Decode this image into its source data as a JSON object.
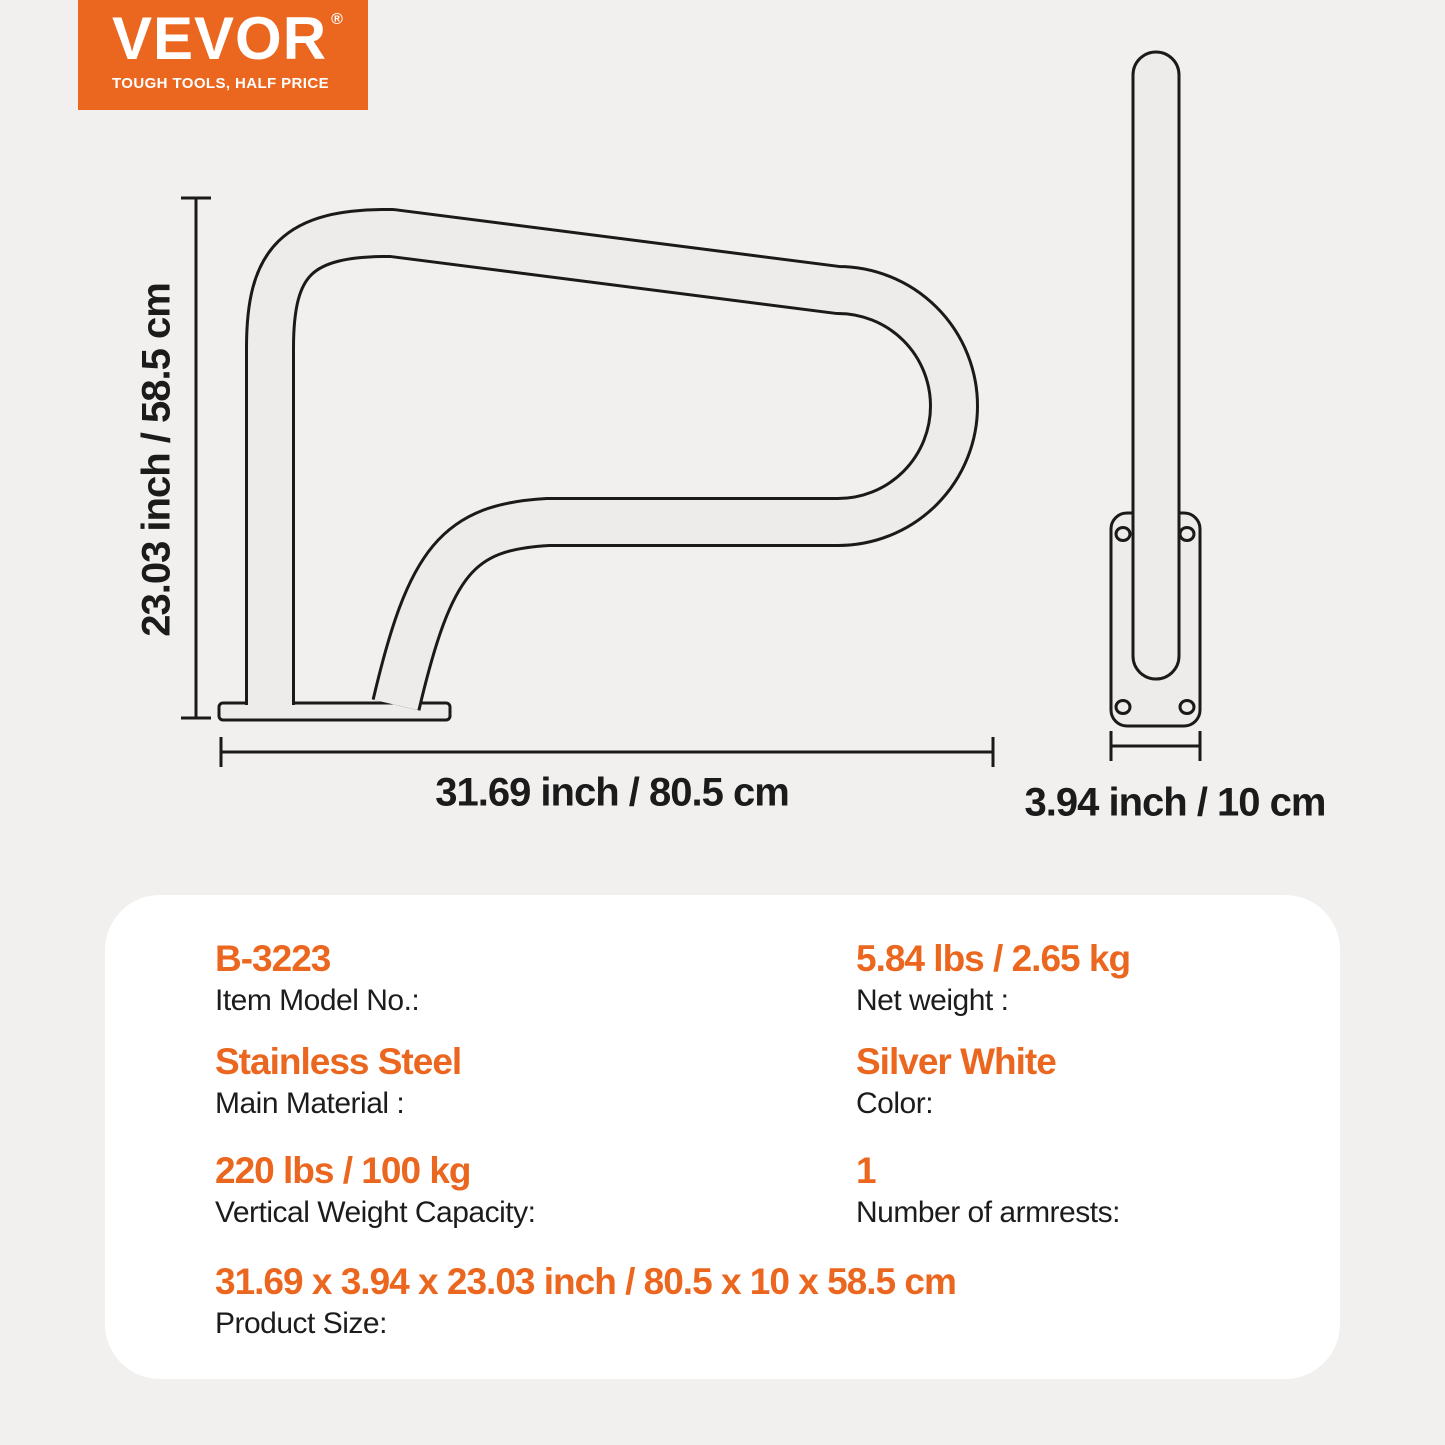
{
  "brand": {
    "name": "VEVOR",
    "registered_mark": "®",
    "tagline": "TOUGH TOOLS, HALF PRICE"
  },
  "colors": {
    "accent_orange": "#EB671F",
    "background_gray": "#F1F0EE",
    "card_white": "#FFFFFF",
    "line_black": "#1A1A1A",
    "tube_fill_gray": "#EDECEA"
  },
  "diagram": {
    "front_view": {
      "height_label": "23.03 inch / 58.5 cm",
      "width_label": "31.69 inch / 80.5 cm"
    },
    "side_view": {
      "depth_label": "3.94 inch / 10 cm"
    }
  },
  "specs": {
    "left_column": [
      {
        "value": "B-3223",
        "label": "Item Model No.:"
      },
      {
        "value": "Stainless Steel",
        "label": "Main Material :"
      },
      {
        "value": "220 lbs / 100 kg",
        "label": "Vertical Weight Capacity:"
      }
    ],
    "right_column": [
      {
        "value": "5.84 lbs / 2.65 kg",
        "label": "Net weight :"
      },
      {
        "value": "Silver White",
        "label": "Color:"
      },
      {
        "value": "1",
        "label": "Number of armrests:"
      }
    ],
    "full_row": {
      "value": "31.69 x 3.94 x 23.03 inch / 80.5 x 10 x 58.5 cm",
      "label": "Product Size:"
    }
  }
}
